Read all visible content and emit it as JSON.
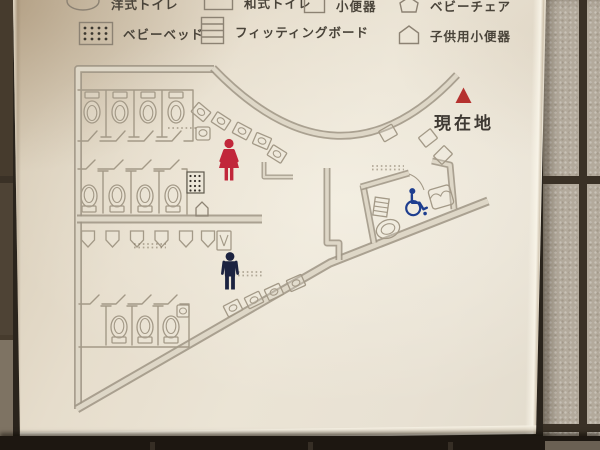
{
  "sign": {
    "type": "restroom-floor-map",
    "current_location": "現在地"
  },
  "legend": {
    "row1": [
      {
        "icon": "western-toilet-icon",
        "label": "洋式トイレ"
      },
      {
        "icon": "squat-toilet-icon",
        "label": "和式トイレ"
      },
      {
        "icon": "urinal-icon",
        "label": "小便器"
      },
      {
        "icon": "baby-chair-icon",
        "label": "ベビーチェア"
      }
    ],
    "row2": [
      {
        "icon": "baby-bed-icon",
        "label": "ベビーベッド"
      },
      {
        "icon": "fitting-board-icon",
        "label": "フィッティングボード"
      },
      {
        "icon": "child-urinal-icon",
        "label": "子供用小便器"
      }
    ]
  },
  "map_symbols": [
    {
      "name": "women-symbol",
      "meaning": "women's restroom area"
    },
    {
      "name": "men-symbol",
      "meaning": "men's restroom area"
    },
    {
      "name": "wheelchair-symbol",
      "meaning": "accessible toilet"
    },
    {
      "name": "current-location-marker",
      "meaning": "you are here"
    }
  ],
  "colors": {
    "women_symbol": "#c1273a",
    "men_symbol": "#1c2340",
    "wheelchair_symbol": "#1e3e8f",
    "location_marker": "#b5312e",
    "location_text": "#3e3933",
    "legend_text": "#4a443a",
    "panel": "#e8e1d3",
    "map_lines": "#9e9484",
    "tile": "#b3aa9c"
  }
}
